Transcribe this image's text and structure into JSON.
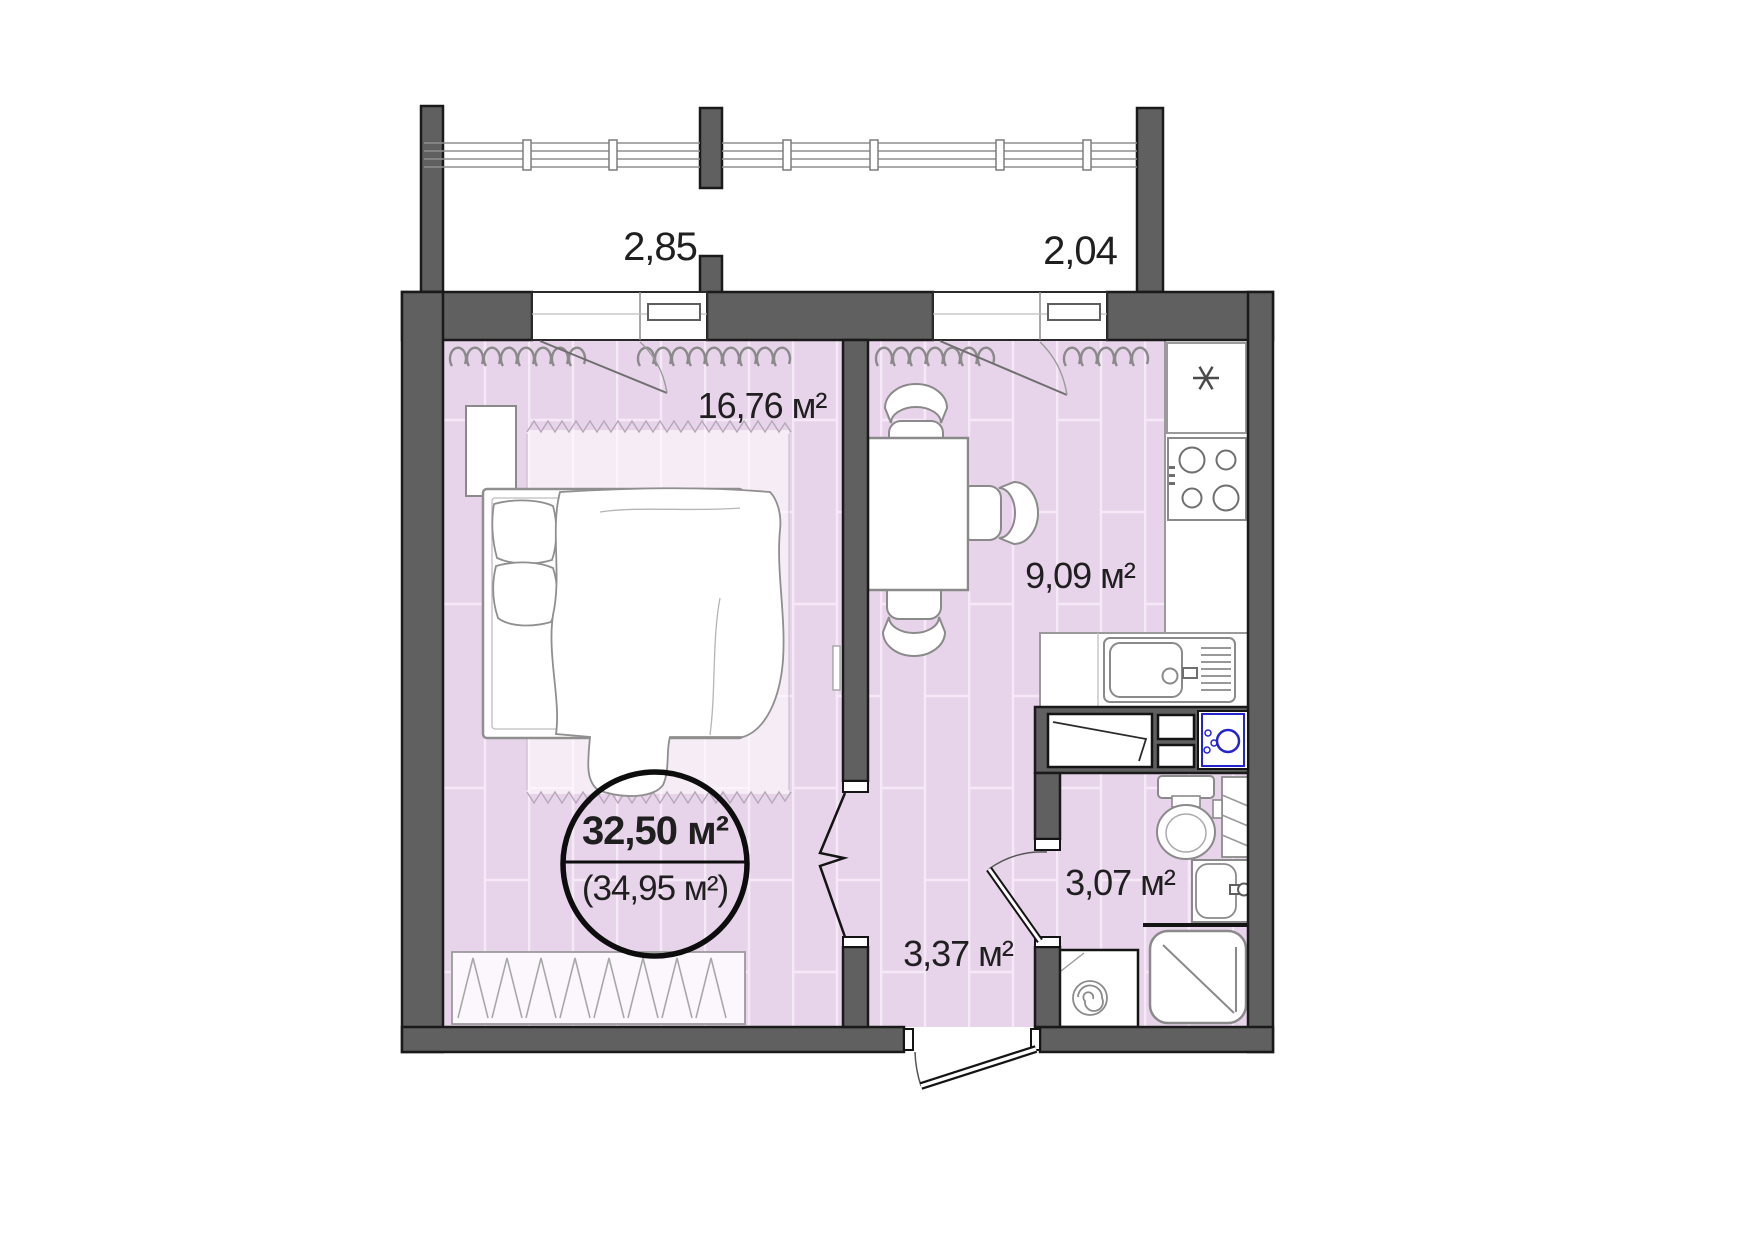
{
  "plan": {
    "type": "apartment-floor-plan",
    "unit": "м²",
    "balcony": {
      "dim_left": "2,85",
      "dim_right": "2,04"
    },
    "rooms": [
      {
        "id": "bedroom",
        "area_label": "16,76 м²"
      },
      {
        "id": "kitchen",
        "area_label": "9,09 м²"
      },
      {
        "id": "hallway",
        "area_label": "3,37 м²"
      },
      {
        "id": "bathroom",
        "area_label": "3,07 м²"
      }
    ],
    "total_area": {
      "main": "32,50 м²",
      "with_balcony": "(34,95 м²)"
    },
    "symbols": [
      "snowflake-fridge-icon",
      "stove-burners-icon",
      "kitchen-sink-icon",
      "dish-drainer-icon",
      "vent-duct-icon",
      "boiler-icon",
      "toilet-icon",
      "towel-rail-icon",
      "wash-basin-icon",
      "shower-icon",
      "washing-machine-spiral-icon",
      "curtain-squiggle-icon",
      "door-swing-icon",
      "folding-door-icon",
      "bed-icon",
      "rug-fringe-icon"
    ],
    "colors": {
      "wall": "#606060",
      "wall_outline": "#1a1a1a",
      "floor": "#e8d4ea",
      "floor_seam": "#f6e9f7",
      "fixture_stroke": "#8a8a8a",
      "accent_blue": "#2424cc",
      "text": "#1f1f1f"
    }
  }
}
